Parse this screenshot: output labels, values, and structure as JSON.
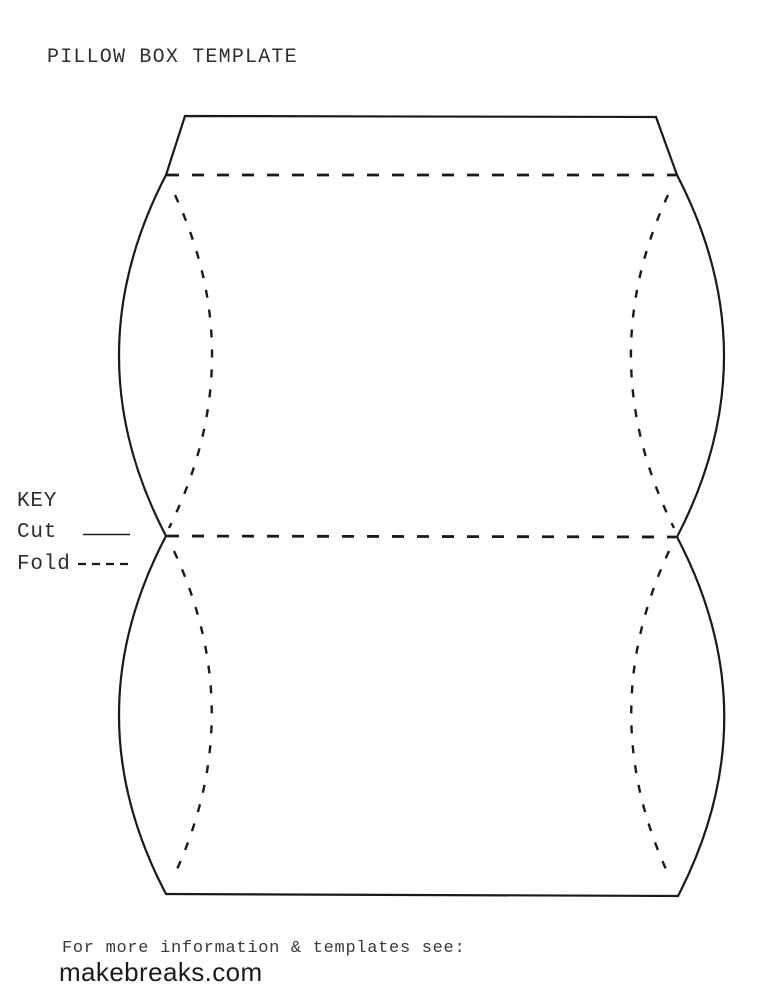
{
  "document": {
    "title": "PILLOW BOX TEMPLATE"
  },
  "legend": {
    "heading": "KEY",
    "items": [
      {
        "label": "Cut",
        "line_style": "solid"
      },
      {
        "label": "Fold",
        "line_style": "dashed"
      }
    ]
  },
  "diagram": {
    "subject": "pillow box template outline",
    "line_color": "#1a1a1a"
  },
  "footer": {
    "note": "For more information & templates see:",
    "website": "makebreaks.com"
  }
}
